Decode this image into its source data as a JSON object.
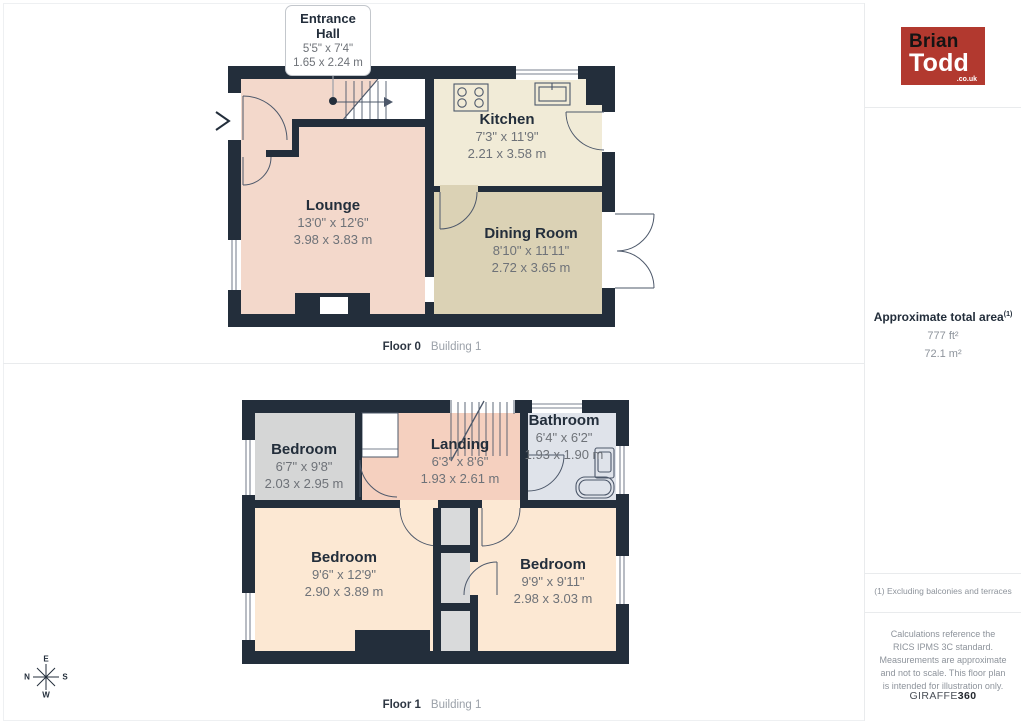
{
  "callout": {
    "title": "Entrance Hall",
    "dims_ft": "5'5\" x 7'4\"",
    "dims_m": "1.65 x 2.24 m"
  },
  "floor0": {
    "caption_floor": "Floor 0",
    "caption_building": "Building 1",
    "rooms": {
      "lounge": {
        "name": "Lounge",
        "dims_ft": "13'0\" x 12'6\"",
        "dims_m": "3.98 x 3.83 m"
      },
      "kitchen": {
        "name": "Kitchen",
        "dims_ft": "7'3\" x 11'9\"",
        "dims_m": "2.21 x 3.58 m"
      },
      "dining": {
        "name": "Dining Room",
        "dims_ft": "8'10\" x 11'11\"",
        "dims_m": "2.72 x 3.65 m"
      }
    }
  },
  "floor1": {
    "caption_floor": "Floor 1",
    "caption_building": "Building 1",
    "rooms": {
      "bedroom_small": {
        "name": "Bedroom",
        "dims_ft": "6'7\" x 9'8\"",
        "dims_m": "2.03 x 2.95 m"
      },
      "landing": {
        "name": "Landing",
        "dims_ft": "6'3\" x 8'6\"",
        "dims_m": "1.93 x 2.61 m"
      },
      "bathroom": {
        "name": "Bathroom",
        "dims_ft": "6'4\" x 6'2\"",
        "dims_m": "1.93 x 1.90 m"
      },
      "bedroom_left": {
        "name": "Bedroom",
        "dims_ft": "9'6\" x 12'9\"",
        "dims_m": "2.90 x 3.89 m"
      },
      "bedroom_right": {
        "name": "Bedroom",
        "dims_ft": "9'9\" x 9'11\"",
        "dims_m": "2.98 x 3.03 m"
      }
    }
  },
  "sidebar": {
    "logo": {
      "line1": "Brian",
      "line2": "Todd",
      "suffix": ".co.uk"
    },
    "area": {
      "title": "Approximate total area",
      "superscript": "(1)",
      "value_ft": "777 ft²",
      "value_m": "72.1 m²"
    },
    "footnote": "(1) Excluding balconies and terraces",
    "disclaimer": "Calculations reference the RICS IPMS 3C standard. Measurements are approximate and not to scale. This floor plan is intended for illustration only.",
    "brand": {
      "name": "GIRAFFE",
      "suffix": "360"
    }
  },
  "compass": {
    "top": "E",
    "left": "N",
    "right": "S",
    "bottom": "W"
  },
  "colors": {
    "wall": "#232e3b",
    "lounge": "#f3d8cb",
    "kitchen": "#f1ebd7",
    "dining_room": "#dbd2b5",
    "bedroom_gray": "#d5d6d6",
    "landing": "#f5d0bf",
    "bathroom": "#dfe3ea",
    "bedroom_peach": "#fce8d3",
    "brand_red": "#b2392f"
  }
}
